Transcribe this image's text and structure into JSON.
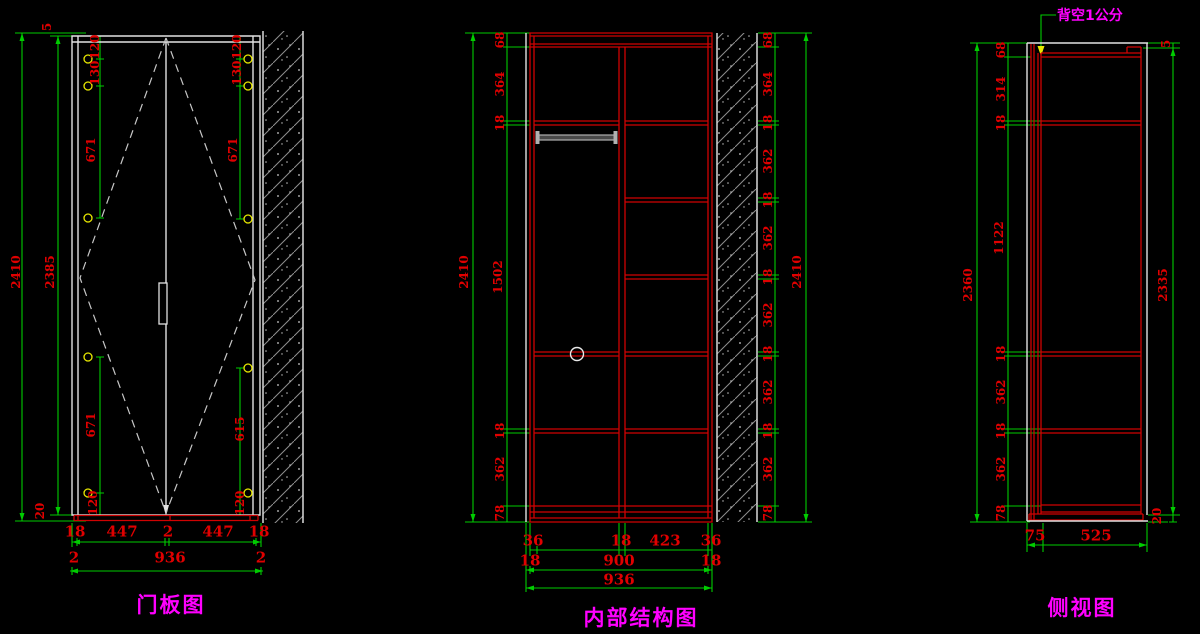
{
  "drawing": {
    "background": "#000000",
    "colors": {
      "dimension_line": "#00cc00",
      "dimension_text": "#e00000",
      "structure_red": "#cf0202",
      "outline_white": "#e2e2e2",
      "hatch_gray": "#8f8f8f",
      "hinge_yellow": "#e8e800",
      "label_magenta": "#ff00ff"
    },
    "views": [
      {
        "id": "door-panel",
        "title": "门板图",
        "dims": {
          "overall_height": "2410",
          "door_height": "2385",
          "top_gap": "5",
          "bottom_gap": "20",
          "left_edge_spacing": [
            "120",
            "130",
            "671",
            "671",
            "120"
          ],
          "right_edge_spacing": [
            "120",
            "130",
            "671",
            "615",
            "120"
          ],
          "bottom_row_1": [
            "18",
            "447",
            "2",
            "447",
            "18"
          ],
          "bottom_row_2": [
            "2",
            "936",
            "2"
          ]
        }
      },
      {
        "id": "internal-structure",
        "title": "内部结构图",
        "dims": {
          "overall_height_left": "2410",
          "overall_height_right": "2410",
          "left_column": [
            "68",
            "364",
            "18",
            "1502",
            "18",
            "362",
            "78"
          ],
          "right_column": [
            "68",
            "364",
            "18",
            "362",
            "18",
            "362",
            "18",
            "362",
            "18",
            "362",
            "18",
            "362",
            "78"
          ],
          "bottom_row_1": [
            "36",
            "18",
            "423",
            "36"
          ],
          "bottom_row_2": [
            "18",
            "900",
            "18"
          ],
          "bottom_row_3": [
            "936"
          ]
        }
      },
      {
        "id": "side-view",
        "title": "侧视图",
        "annotation": "背空1公分",
        "dims": {
          "overall_depth_height": "2360",
          "front_height": "2335",
          "top_gap": "5",
          "bottom_gap": "20",
          "left_column": [
            "68",
            "314",
            "18",
            "1122",
            "18",
            "362",
            "18",
            "362",
            "78"
          ],
          "bottom_row": [
            "75",
            "525"
          ]
        }
      }
    ],
    "labels": [
      {
        "t": "2410",
        "x": 16,
        "y": 272,
        "v": 1
      },
      {
        "t": "2385",
        "x": 50,
        "y": 272,
        "v": 1
      },
      {
        "t": "5",
        "x": 47,
        "y": 27,
        "v": 1
      },
      {
        "t": "20",
        "x": 40,
        "y": 511,
        "v": 1
      },
      {
        "t": "120",
        "x": 95,
        "y": 47,
        "v": 1
      },
      {
        "t": "130",
        "x": 95,
        "y": 73,
        "v": 1
      },
      {
        "t": "671",
        "x": 91,
        "y": 150,
        "v": 1
      },
      {
        "t": "671",
        "x": 91,
        "y": 425,
        "v": 1
      },
      {
        "t": "120",
        "x": 93,
        "y": 503,
        "v": 1
      },
      {
        "t": "120",
        "x": 237,
        "y": 47,
        "v": 1
      },
      {
        "t": "130",
        "x": 237,
        "y": 73,
        "v": 1
      },
      {
        "t": "671",
        "x": 233,
        "y": 150,
        "v": 1
      },
      {
        "t": "615",
        "x": 240,
        "y": 429,
        "v": 1
      },
      {
        "t": "120",
        "x": 240,
        "y": 503,
        "v": 1
      },
      {
        "t": "18",
        "x": 75,
        "y": 532,
        "s": "dim-lg"
      },
      {
        "t": "447",
        "x": 122,
        "y": 532,
        "s": "dim-lg"
      },
      {
        "t": "2",
        "x": 168,
        "y": 532,
        "s": "dim-lg"
      },
      {
        "t": "447",
        "x": 218,
        "y": 532,
        "s": "dim-lg"
      },
      {
        "t": "18",
        "x": 259,
        "y": 532,
        "s": "dim-lg"
      },
      {
        "t": "2",
        "x": 74,
        "y": 558,
        "s": "dim-lg"
      },
      {
        "t": "936",
        "x": 170,
        "y": 558,
        "s": "dim-lg"
      },
      {
        "t": "2",
        "x": 261,
        "y": 558,
        "s": "dim-lg"
      },
      {
        "t": "2410",
        "x": 464,
        "y": 272,
        "v": 1
      },
      {
        "t": "68",
        "x": 500,
        "y": 40,
        "v": 1
      },
      {
        "t": "364",
        "x": 500,
        "y": 84,
        "v": 1
      },
      {
        "t": "18",
        "x": 500,
        "y": 123,
        "v": 1
      },
      {
        "t": "1502",
        "x": 498,
        "y": 277,
        "v": 1
      },
      {
        "t": "18",
        "x": 500,
        "y": 431,
        "v": 1
      },
      {
        "t": "362",
        "x": 500,
        "y": 469,
        "v": 1
      },
      {
        "t": "78",
        "x": 500,
        "y": 513,
        "v": 1
      },
      {
        "t": "68",
        "x": 768,
        "y": 40,
        "v": 1
      },
      {
        "t": "364",
        "x": 768,
        "y": 84,
        "v": 1
      },
      {
        "t": "18",
        "x": 768,
        "y": 123,
        "v": 1
      },
      {
        "t": "362",
        "x": 768,
        "y": 161,
        "v": 1
      },
      {
        "t": "18",
        "x": 768,
        "y": 200,
        "v": 1
      },
      {
        "t": "362",
        "x": 768,
        "y": 238,
        "v": 1
      },
      {
        "t": "18",
        "x": 768,
        "y": 277,
        "v": 1
      },
      {
        "t": "362",
        "x": 768,
        "y": 315,
        "v": 1
      },
      {
        "t": "18",
        "x": 768,
        "y": 354,
        "v": 1
      },
      {
        "t": "362",
        "x": 768,
        "y": 392,
        "v": 1
      },
      {
        "t": "18",
        "x": 768,
        "y": 431,
        "v": 1
      },
      {
        "t": "362",
        "x": 768,
        "y": 469,
        "v": 1
      },
      {
        "t": "78",
        "x": 768,
        "y": 513,
        "v": 1
      },
      {
        "t": "2410",
        "x": 797,
        "y": 272,
        "v": 1
      },
      {
        "t": "36",
        "x": 533,
        "y": 541,
        "s": "dim-lg"
      },
      {
        "t": "18",
        "x": 621,
        "y": 541,
        "s": "dim-lg"
      },
      {
        "t": "423",
        "x": 665,
        "y": 541,
        "s": "dim-lg"
      },
      {
        "t": "36",
        "x": 711,
        "y": 541,
        "s": "dim-lg"
      },
      {
        "t": "18",
        "x": 530,
        "y": 561,
        "s": "dim-lg"
      },
      {
        "t": "900",
        "x": 619,
        "y": 561,
        "s": "dim-lg"
      },
      {
        "t": "18",
        "x": 711,
        "y": 561,
        "s": "dim-lg"
      },
      {
        "t": "936",
        "x": 619,
        "y": 580,
        "s": "dim-lg"
      },
      {
        "t": "2360",
        "x": 968,
        "y": 285,
        "v": 1
      },
      {
        "t": "68",
        "x": 1001,
        "y": 50,
        "v": 1
      },
      {
        "t": "314",
        "x": 1001,
        "y": 89,
        "v": 1
      },
      {
        "t": "18",
        "x": 1001,
        "y": 123,
        "v": 1
      },
      {
        "t": "1122",
        "x": 999,
        "y": 238,
        "v": 1
      },
      {
        "t": "18",
        "x": 1001,
        "y": 354,
        "v": 1
      },
      {
        "t": "362",
        "x": 1001,
        "y": 392,
        "v": 1
      },
      {
        "t": "18",
        "x": 1001,
        "y": 431,
        "v": 1
      },
      {
        "t": "362",
        "x": 1001,
        "y": 469,
        "v": 1
      },
      {
        "t": "78",
        "x": 1001,
        "y": 513,
        "v": 1
      },
      {
        "t": "5",
        "x": 1166,
        "y": 44,
        "v": 1
      },
      {
        "t": "2335",
        "x": 1163,
        "y": 285,
        "v": 1
      },
      {
        "t": "20",
        "x": 1157,
        "y": 516,
        "v": 1
      },
      {
        "t": "75",
        "x": 1035,
        "y": 536,
        "s": "dim-lg"
      },
      {
        "t": "525",
        "x": 1096,
        "y": 536,
        "s": "dim-lg"
      }
    ]
  }
}
